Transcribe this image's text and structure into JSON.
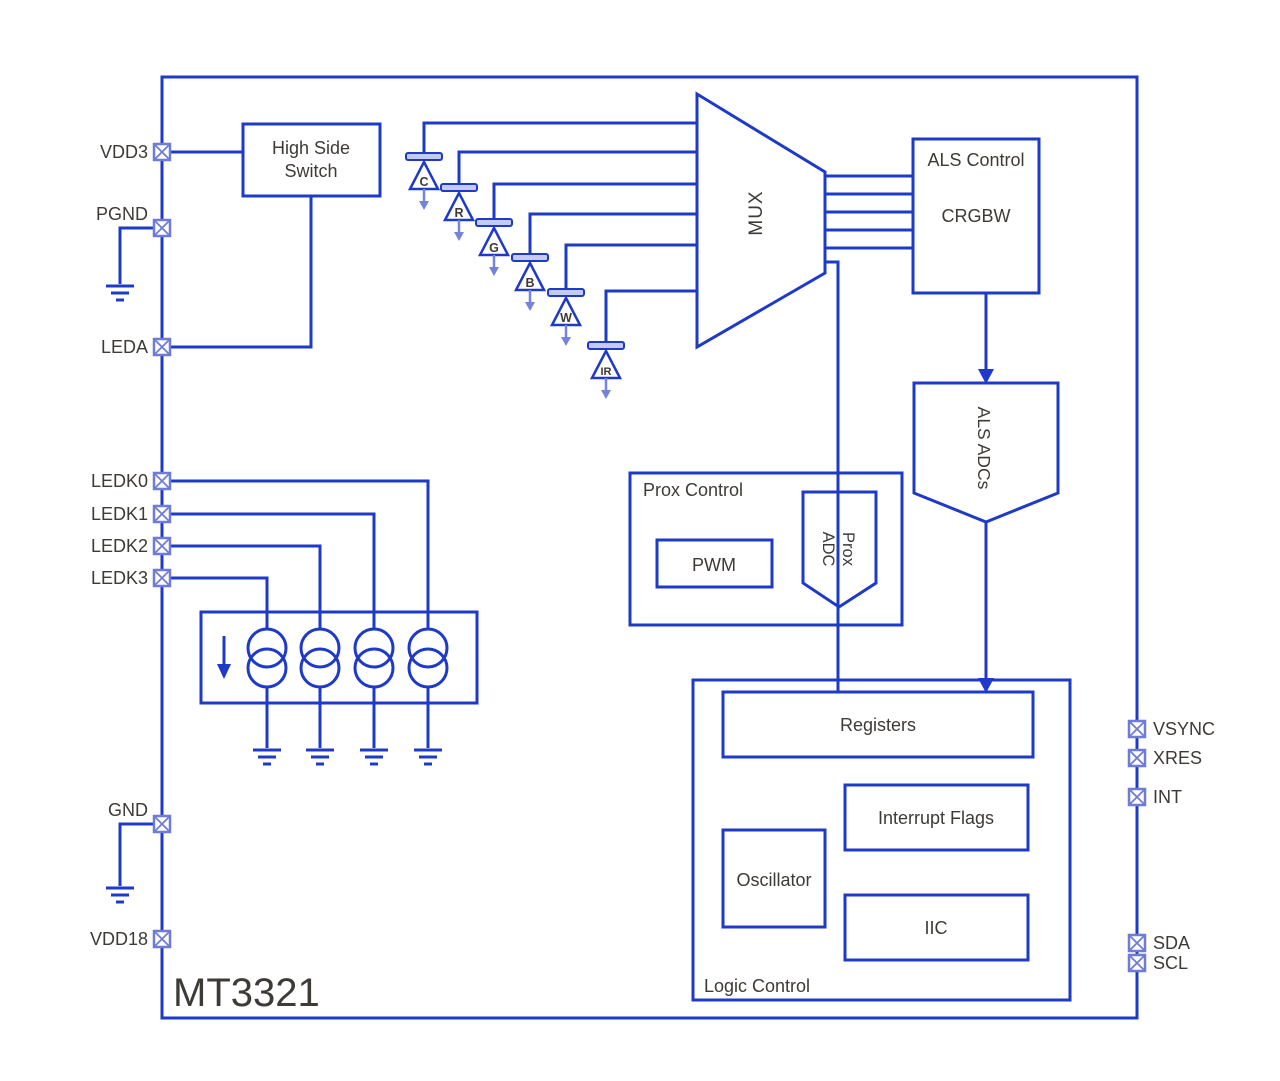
{
  "title": "MT3321",
  "pins": {
    "left": [
      "VDD3",
      "PGND",
      "LEDA",
      "LEDK0",
      "LEDK1",
      "LEDK2",
      "LEDK3",
      "GND",
      "VDD18"
    ],
    "right": [
      "VSYNC",
      "XRES",
      "INT",
      "SDA",
      "SCL"
    ]
  },
  "blocks": {
    "high_side_switch": {
      "line1": "High Side",
      "line2": "Switch"
    },
    "mux": {
      "label": "MUX"
    },
    "als_control": {
      "title": "ALS Control",
      "body": "CRGBW"
    },
    "als_adcs": {
      "label": "ALS ADCs"
    },
    "prox_control": {
      "title": "Prox Control",
      "pwm": "PWM",
      "prox_adc_line1": "Prox",
      "prox_adc_line2": "ADC"
    },
    "logic_control": {
      "title": "Logic Control",
      "registers": "Registers",
      "interrupt_flags": "Interrupt Flags",
      "oscillator": "Oscillator",
      "iic": "IIC"
    }
  },
  "photodiodes": [
    {
      "label": "C",
      "color": "#3e3a36"
    },
    {
      "label": "R",
      "color": "#cc4a3f"
    },
    {
      "label": "G",
      "color": "#3fa44c"
    },
    {
      "label": "B",
      "color": "#56a7de"
    },
    {
      "label": "W",
      "color": "#3e3a36"
    },
    {
      "label": "IR",
      "color": "#3e3a36"
    }
  ],
  "colors": {
    "wire_blue": "#1e3ac6",
    "light_blue": "#7583dc",
    "pin_blue": "#6e7cd8",
    "text": "#3e3a36",
    "background": "#ffffff"
  }
}
